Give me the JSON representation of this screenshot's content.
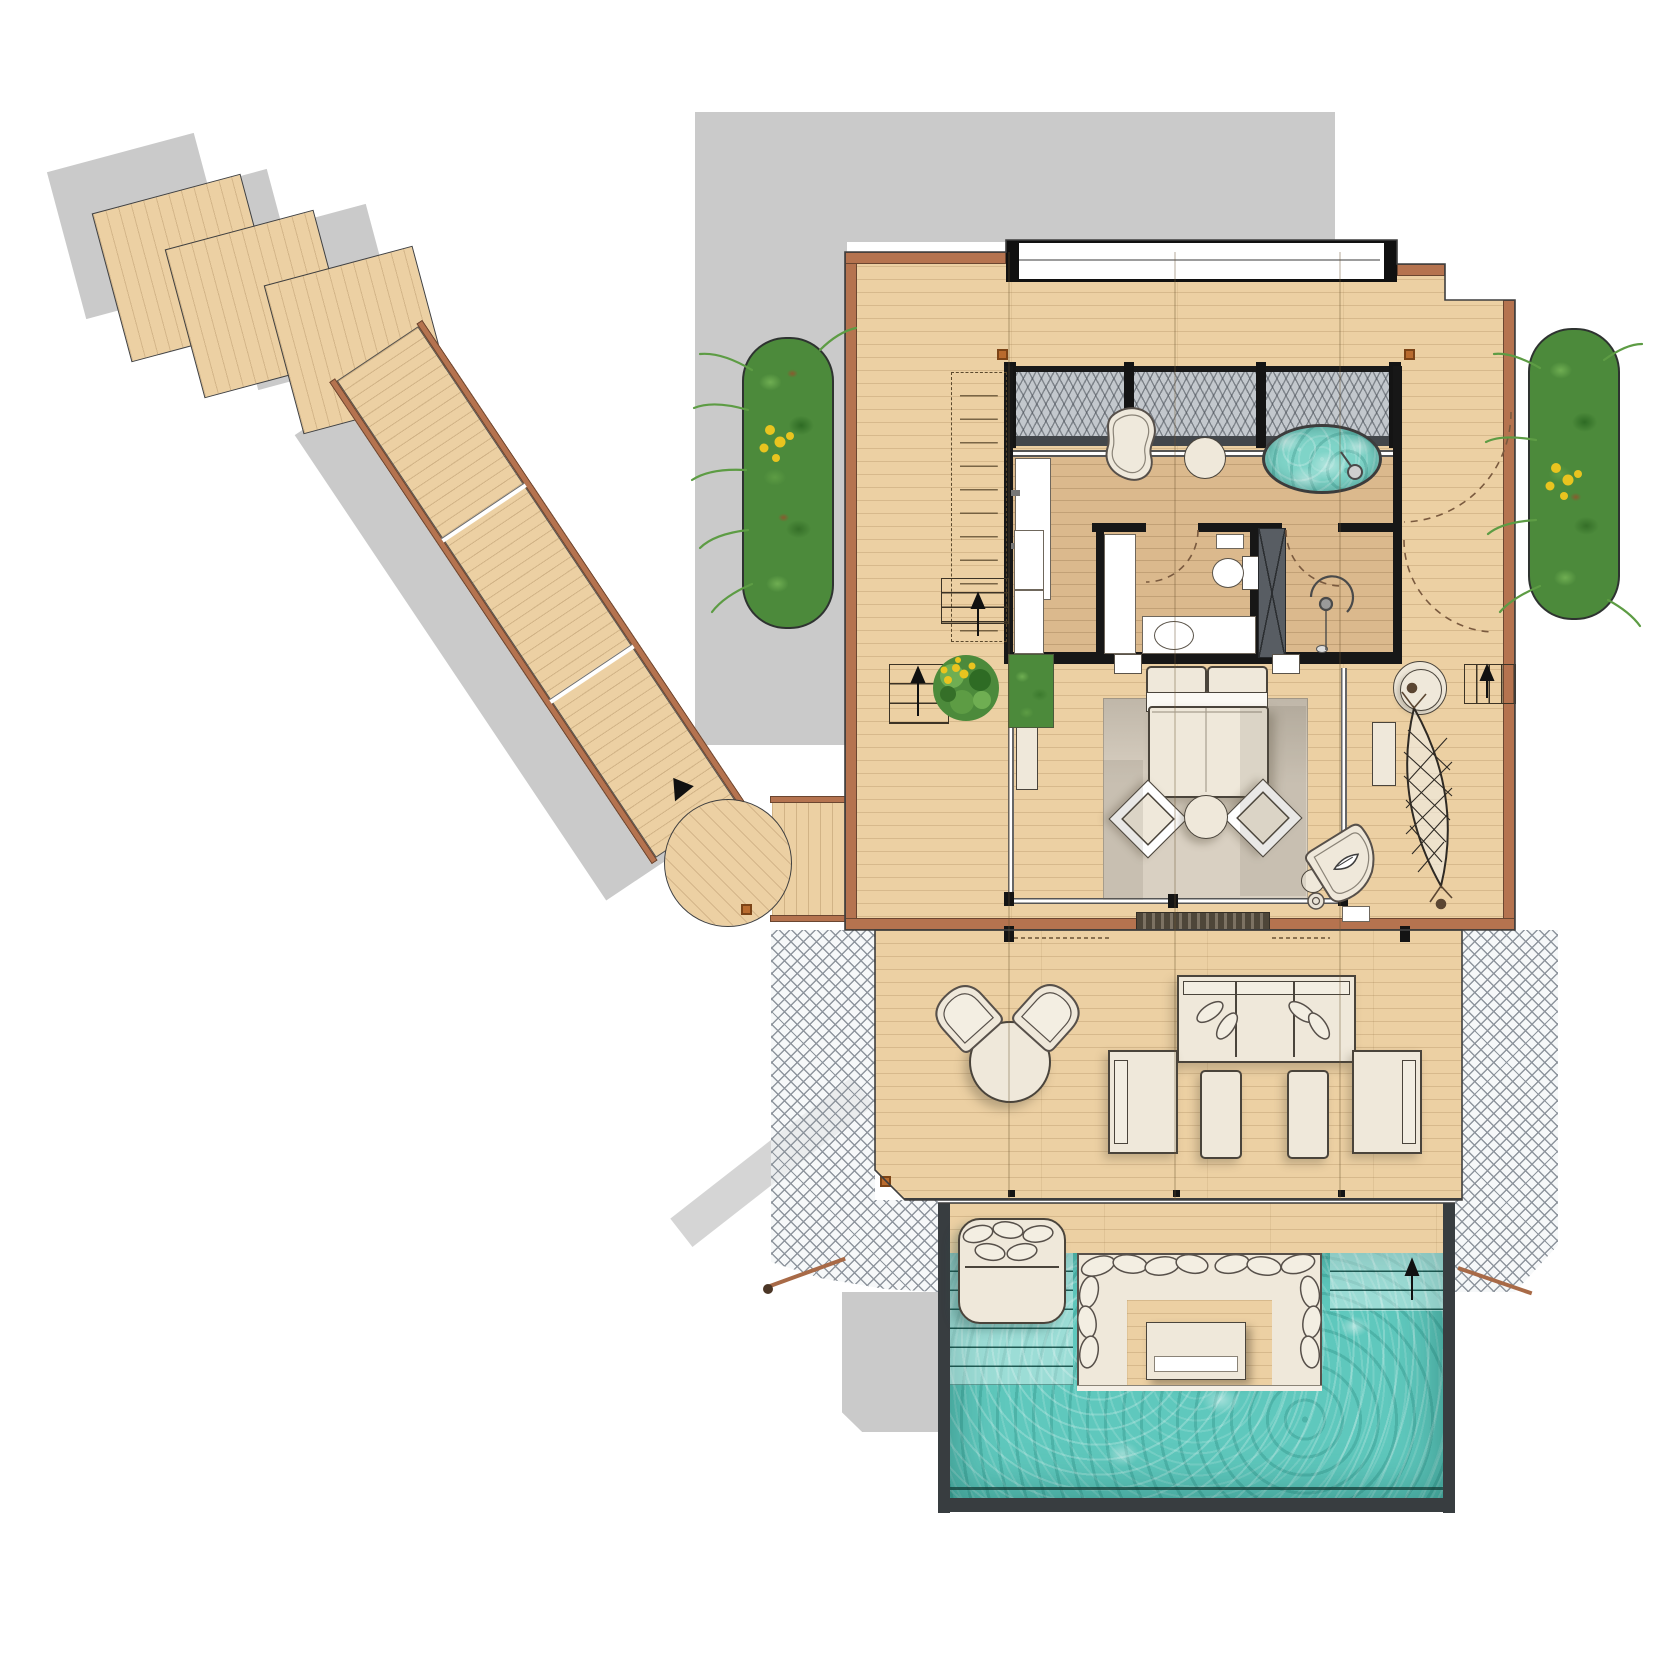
{
  "document": {
    "kind": "architectural-floor-plan",
    "view": "top-down",
    "subject": "overwater pool villa with boardwalk"
  },
  "colors": {
    "background": "#ffffff",
    "shadow": "#cacaca",
    "wood": "#ecd0a3",
    "wood_interior": "#e3bf92",
    "trim_brown": "#b5734f",
    "wall_black": "#171717",
    "mesh_gray": "#c3c8cd",
    "net_line": "#8f969e",
    "water_turquoise": "#5fc8bd",
    "water_light": "#a9e4dc",
    "cushion_cream": "#efe8da",
    "outline": "#4a443b",
    "rug_beige": "#d9d0c2",
    "foliage_green": "#4c8a3b",
    "flower_yellow": "#e9c41f",
    "marker_orange": "#b96b2e"
  },
  "features": [
    "stepping-platforms",
    "boardwalk",
    "circular-landing",
    "entry-bridge",
    "catamaran-net-left",
    "catamaran-net-right",
    "upper-deck",
    "skylight-band",
    "mesh-transom",
    "bathroom",
    "vanity",
    "kidney-stone-seat",
    "stool",
    "oval-jacuzzi-tub",
    "wardrobe",
    "toilet-room",
    "service-shaft",
    "shower-room",
    "bedroom",
    "double-bed",
    "rug",
    "armchairs",
    "ottoman",
    "chaise-lounge",
    "hammock",
    "round-daybed",
    "deck-stairs",
    "planter-left",
    "planter-right",
    "potted-plant",
    "lower-deck",
    "dining-set",
    "outdoor-sofa-set",
    "pool-deck",
    "infinity-pool",
    "pool-steps-left",
    "pool-steps-right",
    "sunken-lounge",
    "floating-daybed"
  ],
  "counts": {
    "stepping_platforms": 3,
    "armchairs_bedroom": 2,
    "sofa_seats": 3,
    "lounge_armchairs": 2,
    "ottomans": 2
  }
}
